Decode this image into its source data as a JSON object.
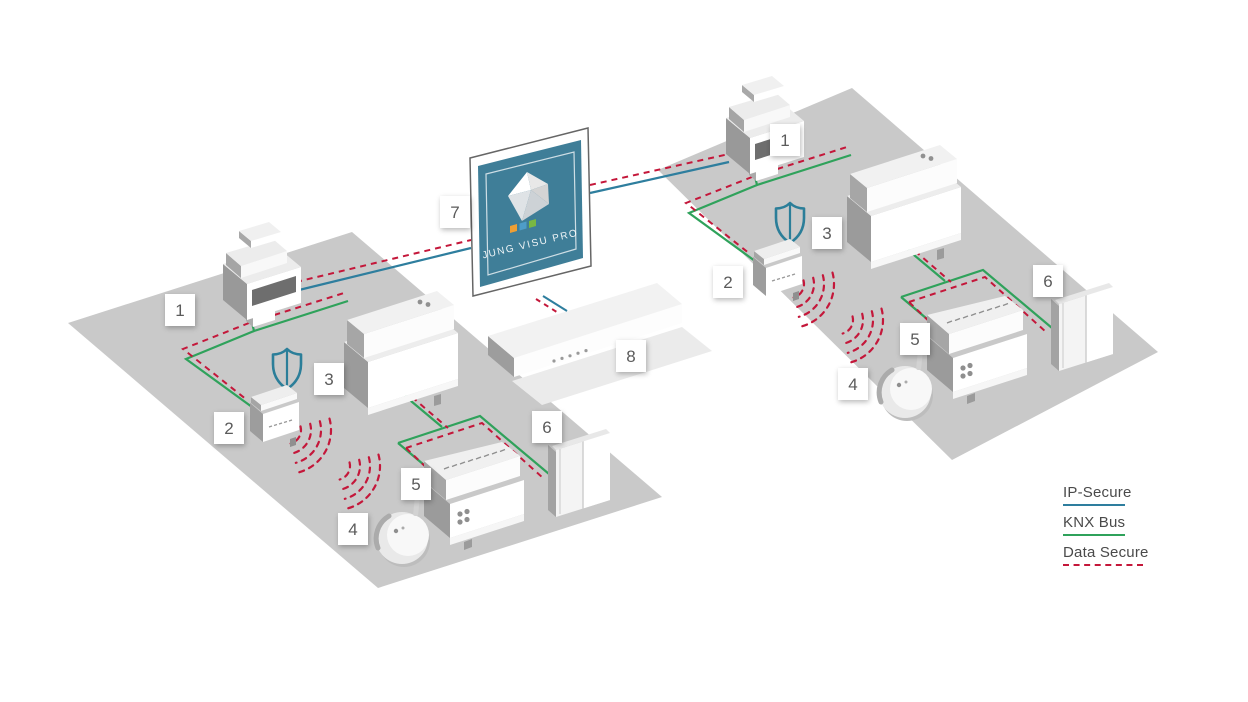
{
  "monitor": {
    "logo_text": "JUNG VISU PRO",
    "marker": "7"
  },
  "server": {
    "marker": "8"
  },
  "legend": {
    "items": [
      {
        "label": "IP-Secure",
        "color": "#2E7E9E",
        "style": "solid"
      },
      {
        "label": "KNX Bus",
        "color": "#2FA25B",
        "style": "solid"
      },
      {
        "label": "Data Secure",
        "color": "#C4173A",
        "style": "dashed"
      }
    ]
  },
  "installations": [
    {
      "id": "left",
      "markers": [
        "1",
        "2",
        "3",
        "4",
        "5",
        "6"
      ]
    },
    {
      "id": "right",
      "markers": [
        "1",
        "2",
        "3",
        "4",
        "5",
        "6"
      ]
    }
  ],
  "icons": {
    "shield": "security-shield-icon",
    "wireless": "rf-wireless-arcs",
    "logo": "jung-visu-pro-gem-logo"
  },
  "colors": {
    "ip_secure": "#2E7E9E",
    "knx_bus": "#2FA25B",
    "data_secure": "#C4173A",
    "floor": "#C9C9C9",
    "screen_teal": "#3F7E98",
    "shield_teal": "#2B7E99"
  }
}
